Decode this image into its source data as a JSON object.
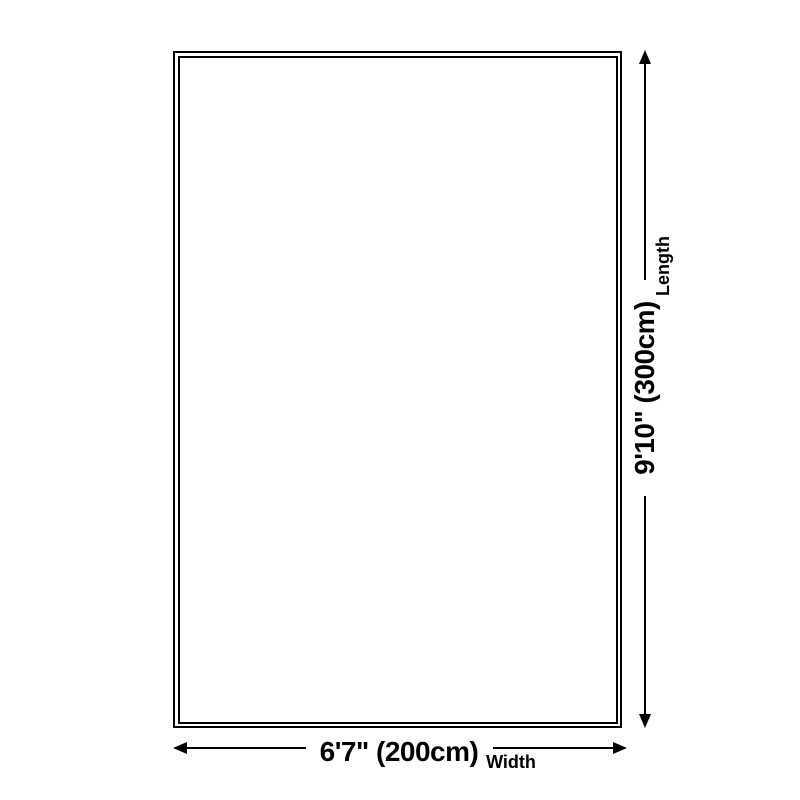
{
  "diagram": {
    "shape": "rectangle-outline",
    "style": {
      "line_color": "#000000",
      "background_color": "#ffffff"
    }
  },
  "dimensions": {
    "width": {
      "value": "6'7\" (200cm)",
      "label": "Width"
    },
    "length": {
      "value": "9'10\" (300cm)",
      "label": "Length"
    }
  }
}
